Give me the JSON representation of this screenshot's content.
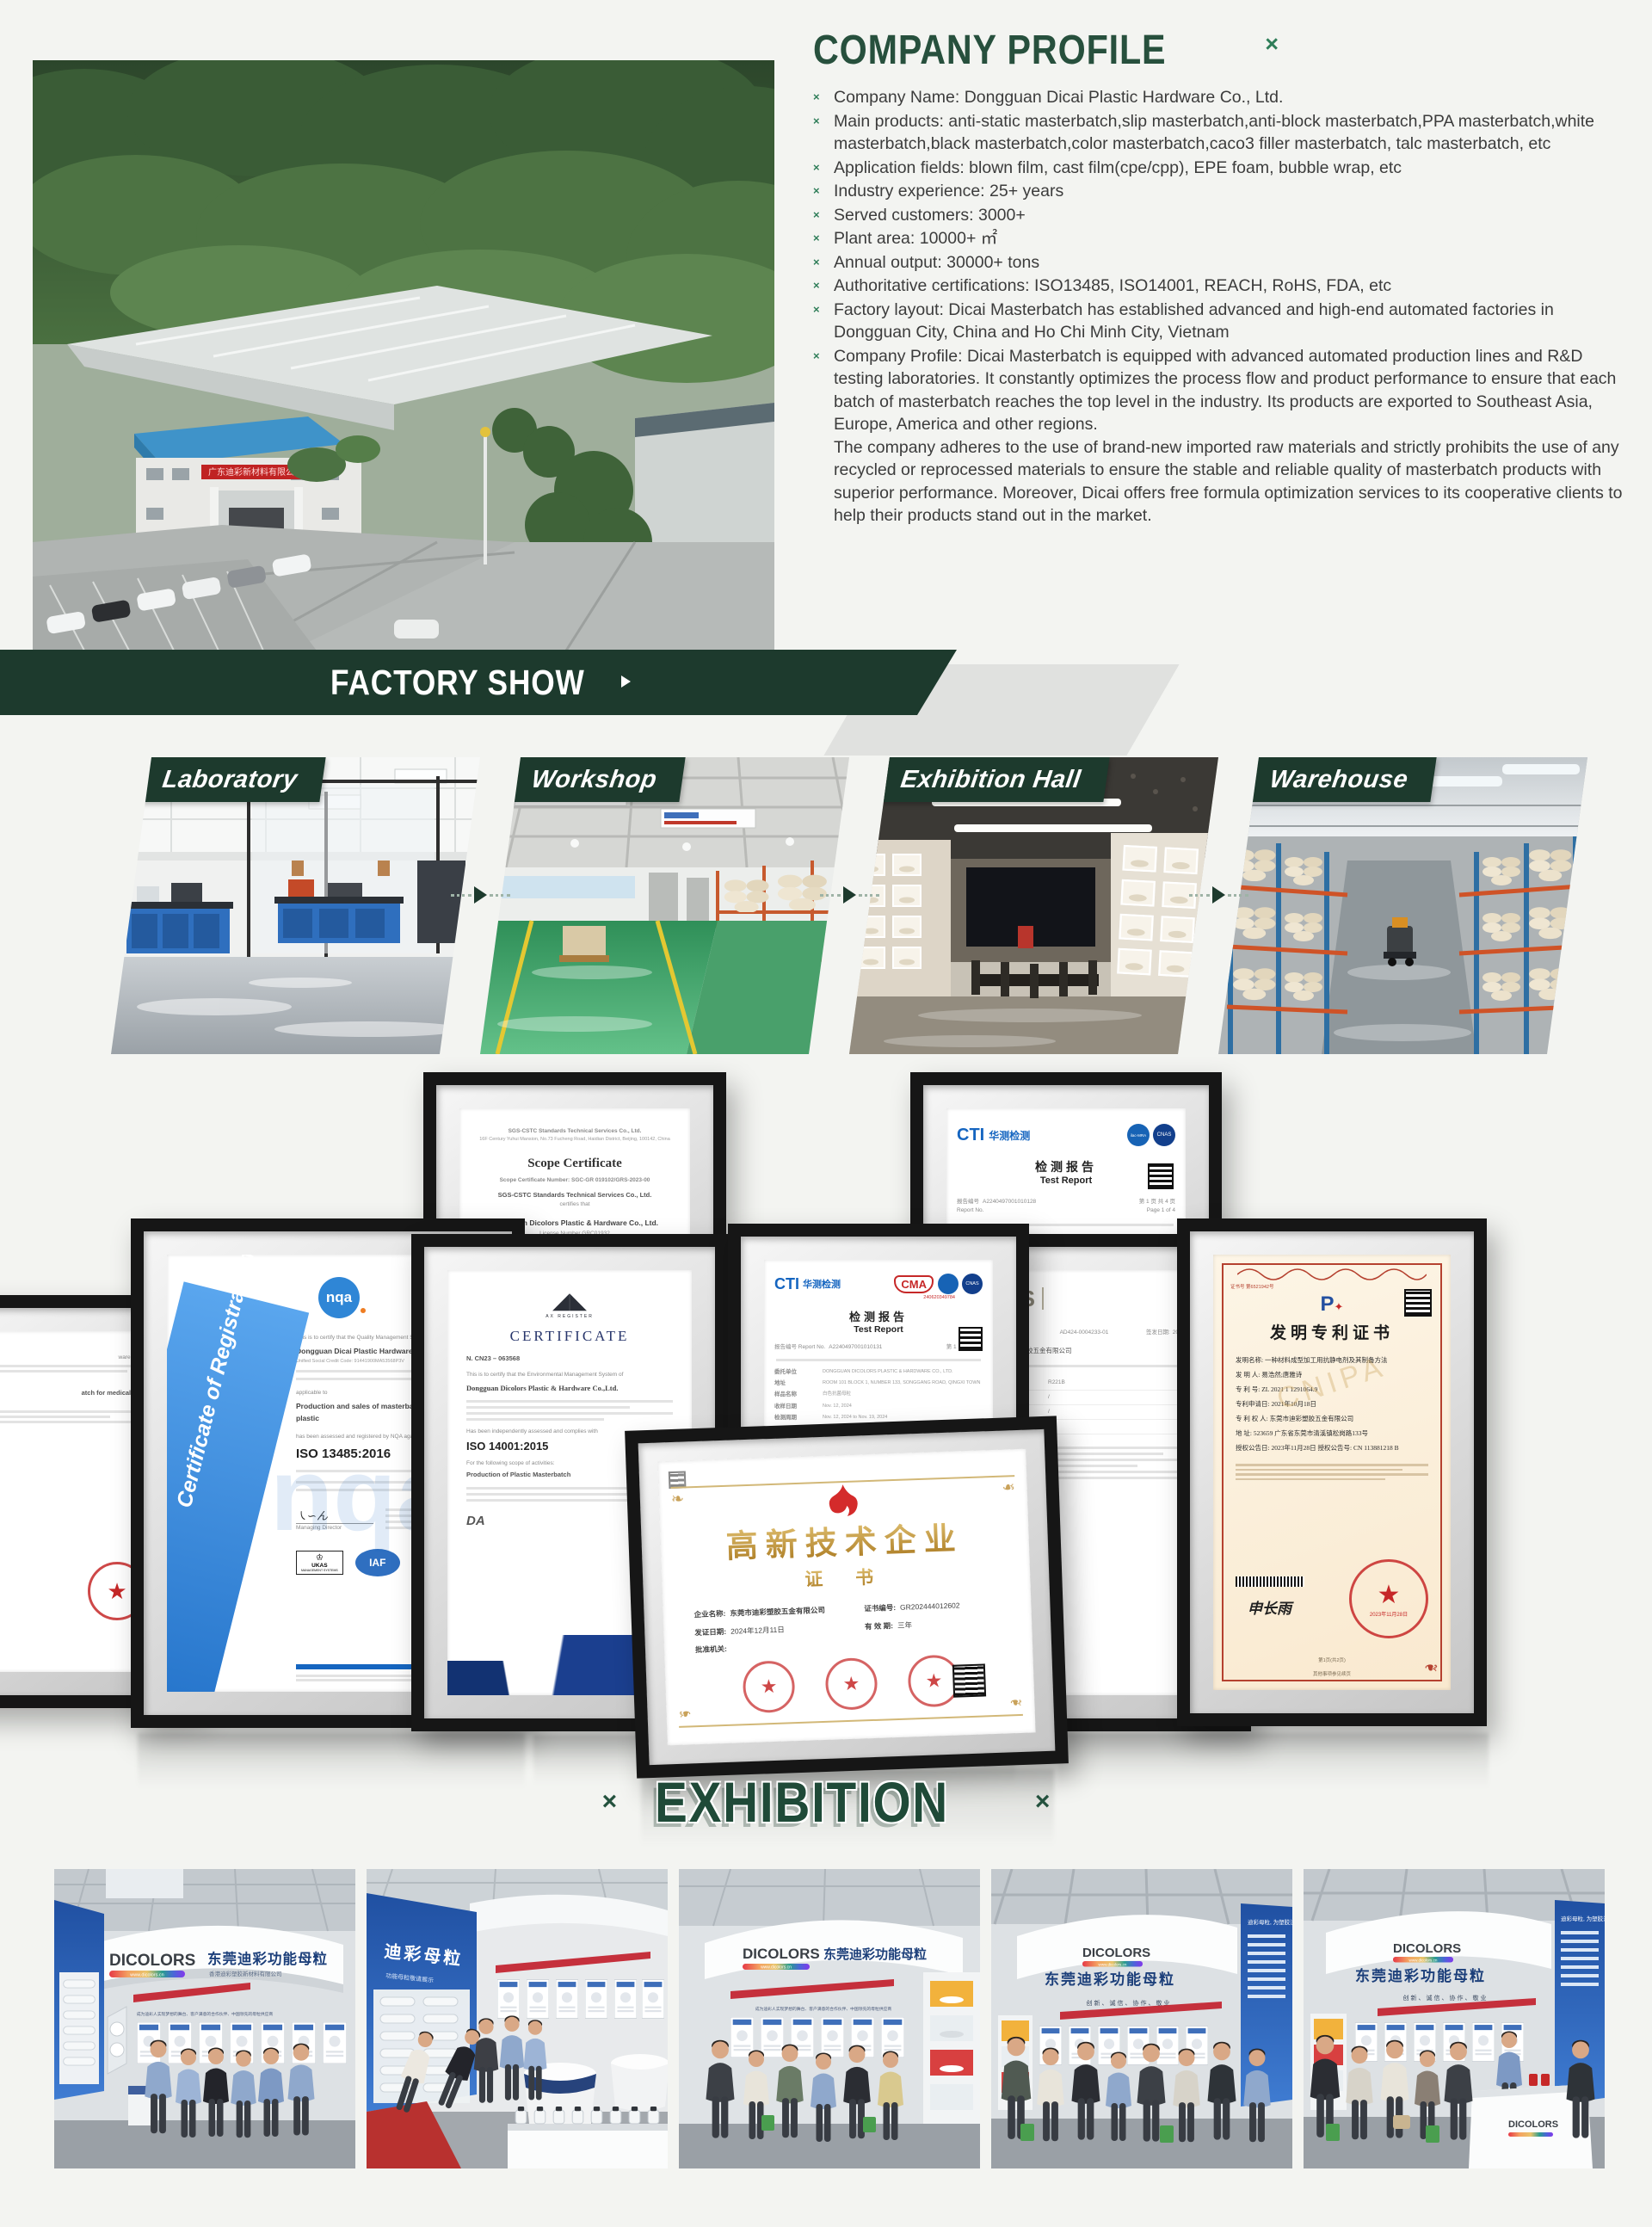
{
  "company_profile": {
    "title": "COMPANY PROFILE",
    "corner_mark": "×",
    "bullet_marker": "×",
    "bullets": [
      "Company Name: Dongguan Dicai Plastic Hardware Co., Ltd.",
      "Main products: anti-static masterbatch,slip masterbatch,anti-block masterbatch,PPA masterbatch,white masterbatch,black masterbatch,color masterbatch,caco3 filler masterbatch, talc masterbatch, etc",
      "Application fields: blown film, cast film(cpe/cpp), EPE foam, bubble wrap, etc",
      "Industry experience: 25+ years",
      "Served customers: 3000+",
      "Plant area: 10000+ ㎡",
      "Annual output: 30000+ tons",
      "Authoritative certifications: ISO13485, ISO14001, REACH, RoHS, FDA, etc",
      "Factory layout: Dicai Masterbatch has established advanced and high-end automated factories in Dongguan City, China and Ho Chi Minh City, Vietnam",
      "Company Profile: Dicai Masterbatch is equipped with advanced automated production lines and R&D testing laboratories. It constantly optimizes the process flow and product performance to ensure that each batch of masterbatch reaches the top level in the industry. Its products are exported to Southeast Asia, Europe, America and other regions.\nThe company adheres to the use of brand-new imported raw materials and strictly prohibits the use of any recycled or reprocessed materials to ensure the stable and reliable quality of masterbatch products with superior performance. Moreover, Dicai offers free formula optimization services to its cooperative clients to help their products stand out in the market."
    ]
  },
  "factory_photo": {
    "sign_text": "广东迪彩新材料有限公司"
  },
  "factory_show": {
    "title": "FACTORY SHOW",
    "items": [
      {
        "label": "Laboratory"
      },
      {
        "label": "Workshop"
      },
      {
        "label": "Exhibition Hall"
      },
      {
        "label": "Warehouse"
      }
    ]
  },
  "certificates": {
    "scope": {
      "header": "SGS-CSTC Standards Technical Services Co., Ltd.",
      "address": "16F Century Yuhui Mansion, No.73 Fucheng Road, Haidian District, Beijing, 100142, China",
      "title": "Scope Certificate",
      "cert_no": "Scope Certificate Number: SGC-GR 019102/GRS-2023-00",
      "body1": "SGS-CSTC Standards Technical Services Co., Ltd.",
      "certifies": "certifies that",
      "company": "Dongguan Dicolors Plastic & Hardware Co., Ltd.",
      "license": "License Number GRC01932",
      "addr2": "Room 101, Block1, Number133, Songgang Road, Qingxi Town",
      "addr3": "Dongguan City, 523000",
      "addr4": "Guangdong Province, China",
      "assessed": "has been audited and found to be in conformity with the",
      "standard": "Global Recycled Standard (GRS)",
      "version": "« Version 4.0 »"
    },
    "cti": {
      "logo": "CTI",
      "logo_cn": "华测检测",
      "cnas": "CNAS",
      "mra": "ilac-MRA",
      "title": "检测报告",
      "subtitle": "Test Report",
      "report_label": "报告编号",
      "report_label_en": "Report No.",
      "report_no": "A2240497001010128",
      "page": "第 1 页 共 4 页",
      "page_en": "Page 1 of 4",
      "company_cn": "东莞市迪彩塑胶五金有限公司",
      "company_en": "DONGGUAN DICOLORS PLASTIC & HARDWARE CO., LTD."
    },
    "nqa": {
      "ribbon": "Certificate of Registration",
      "logo": "nqa",
      "line1": "This is to certify that the Quality Management System of",
      "company": "Dongguan Dicai Plastic Hardware Co., Ltd.",
      "code": "Unified Social Credit Code: 91441900MA53568P3V",
      "applicable": "applicable to",
      "scope": "Production and sales of masterbatch for medical plastic",
      "line2": "has been assessed and registered by NQA against the provisions of",
      "standard": "ISO 13485:2016",
      "director": "Managing Director",
      "ukas": "UKAS",
      "ukas_sub": "MANAGEMENT SYSTEMS",
      "iaf": "IAF"
    },
    "iso14001": {
      "title": "CERTIFICATE",
      "number": "N. CN23 – 063568",
      "line1": "This is to certify that the Environmental Management System of",
      "company": "Dongguan Dicolors Plastic & Hardware Co.,Ltd.",
      "line2": "Has been independently assessed and complies with",
      "standard": "ISO 14001:2015",
      "scope_label": "For the following scope of activities:",
      "scope": "Production of Plastic Masterbatch",
      "da": "DA"
    },
    "cma": {
      "logo": "CTI",
      "logo_cn": "华测检测",
      "cma": "CMA",
      "cma_no": "240620349784",
      "cnas": "CNAS",
      "title": "检测报告",
      "subtitle": "Test Report",
      "report_label": "报告编号 Report No.",
      "report_no": "A2240497001010131",
      "page": "第 1 页 共 7 页",
      "rows": [
        [
          "委托单位",
          "DONGGUAN DICOLORS PLASTIC & HARDWARE CO., LTD."
        ],
        [
          "地址",
          "ROOM 101 BLOCK 1, NUMBER 133, SONGGANG ROAD, QINGXI TOWN"
        ],
        [
          "样品名称",
          "白色抗菌母粒"
        ],
        [
          "收样日期",
          "Nov. 12, 2024"
        ],
        [
          "检测周期",
          "Nov. 12, 2024 to Nov. 19, 2024"
        ]
      ]
    },
    "sgs": {
      "logo": "SGS",
      "title": "检测报告",
      "no": "AD424-0004233-01",
      "date_label": "签发日期:",
      "date": "2024-06-29",
      "company": "东莞市迪彩塑胶五金有限公司",
      "rows": [
        [
          "样品名称",
          "R221B"
        ],
        [
          "型 号",
          "/"
        ],
        [
          "生产日期",
          "/"
        ],
        [
          "生产厂商",
          "/"
        ]
      ]
    },
    "patent": {
      "cert_no": "证书号 第6521942号",
      "title": "发明专利证书",
      "fields": [
        "发明名称: 一种材料成型加工用抗静电剂及其制备方法",
        "发 明 人: 易浩然;唐雅诗",
        "专 利 号: ZL 2021 1 1291064.9",
        "专利申请日: 2021年10月18日",
        "专 利 权 人: 东莞市迪彩塑胶五金有限公司",
        "地 址: 523659 广东省东莞市清溪镇松岗路133号",
        "授权公告日: 2023年11月28日    授权公告号: CN 113881218 B"
      ],
      "signature": "申长雨",
      "seal_date": "2023年11月28日",
      "footer": "第1页(共2页)",
      "note": "其他事项参见续页",
      "watermark": "CNIPA"
    },
    "hitech": {
      "title": "高新技术企业",
      "subtitle": "证 书",
      "name_label": "企业名称:",
      "name": "东莞市迪彩塑胶五金有限公司",
      "no_label": "证书编号:",
      "no": "GR202444012602",
      "date_label": "发证日期:",
      "date": "2024年12月11日",
      "valid_label": "有 效 期:",
      "valid": "三年",
      "authority_label": "批准机关:"
    },
    "partial_left": {
      "line1": "ware Co., Ltd.",
      "line2": "atch for medical plastic"
    }
  },
  "exhibition": {
    "title": "EXHIBITION",
    "left_mark": "×",
    "right_mark": "×",
    "photos": [
      {
        "brand": "DICOLORS",
        "url": "www.dicolors.cn",
        "cn": "东莞迪彩功能母粒",
        "sub": "香港迪彩塑胶新材料有限公司",
        "slogan": "成为迪彩人实现梦想的舞台、客户满意的合作伙伴、中国领先的母粒供应商"
      },
      {
        "wall": "迪彩母粒",
        "wall_sub": "功能母粒敬请展示"
      },
      {
        "brand": "DICOLORS",
        "url": "www.dicolors.cn",
        "cn": "东莞迪彩功能母粒",
        "slogan": "成为迪彩人实现梦想的舞台、客户满意的合作伙伴、中国领先的母粒供应商"
      },
      {
        "brand": "DICOLORS",
        "url": "www.dicolors.cn",
        "cn": "东莞迪彩功能母粒",
        "motto": "创新、诚信、协作、敬业",
        "side": "迪彩母粒, 为塑胶注入功能和色彩"
      },
      {
        "brand": "DICOLORS",
        "url": "www.dicolors.cn",
        "cn": "东莞迪彩功能母粒",
        "motto": "创新、诚信、协作、敬业",
        "side": "迪彩母粒, 为塑胶注入功能和色彩"
      }
    ]
  },
  "colors": {
    "brand_green": "#1d3a2d",
    "heading_green": "#27503d",
    "accent_red": "#c5303c",
    "seal_red": "#c62828",
    "gold": "#bd9040"
  }
}
